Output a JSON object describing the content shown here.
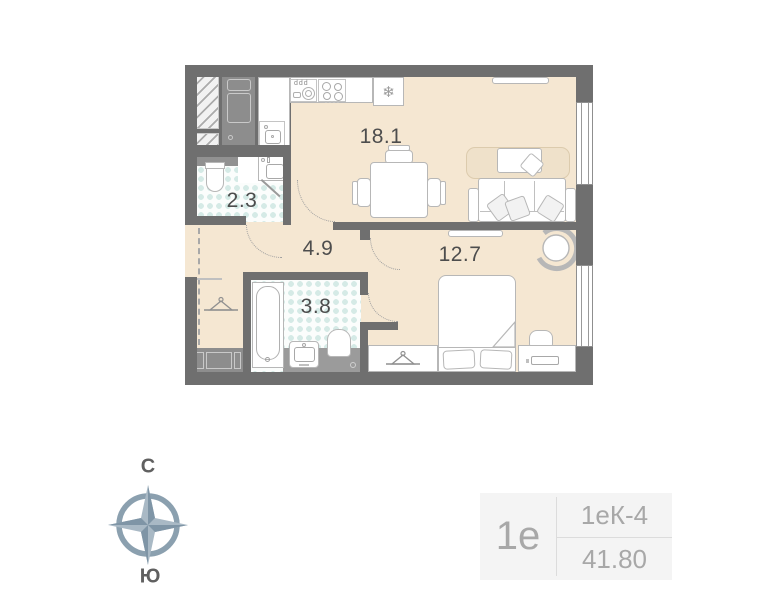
{
  "plan": {
    "rooms": [
      {
        "name": "kitchen-living-room",
        "area": "18.1"
      },
      {
        "name": "wc",
        "area": "2.3"
      },
      {
        "name": "hallway",
        "area": "4.9"
      },
      {
        "name": "bathroom",
        "area": "3.8"
      },
      {
        "name": "bedroom",
        "area": "12.7"
      }
    ],
    "icons": {
      "fridge_snowflake": "❄",
      "cup_hooks": "ddd"
    }
  },
  "compass": {
    "north": "С",
    "south": "Ю"
  },
  "info_card": {
    "unit_type": "1е",
    "layout_code": "1еК-4",
    "total_area": "41.80"
  },
  "colors": {
    "floor_beige": "#f5e7d2",
    "wall_gray": "#6f6f6f",
    "tile_dot_teal": "#d5eae6",
    "furniture_outline": "#b7b7b7",
    "mid_gray_furniture": "#919191",
    "compass_slate": "#8ba0af",
    "info_text_gray": "#a8a8a8",
    "label_text": "#4d4d4d"
  }
}
